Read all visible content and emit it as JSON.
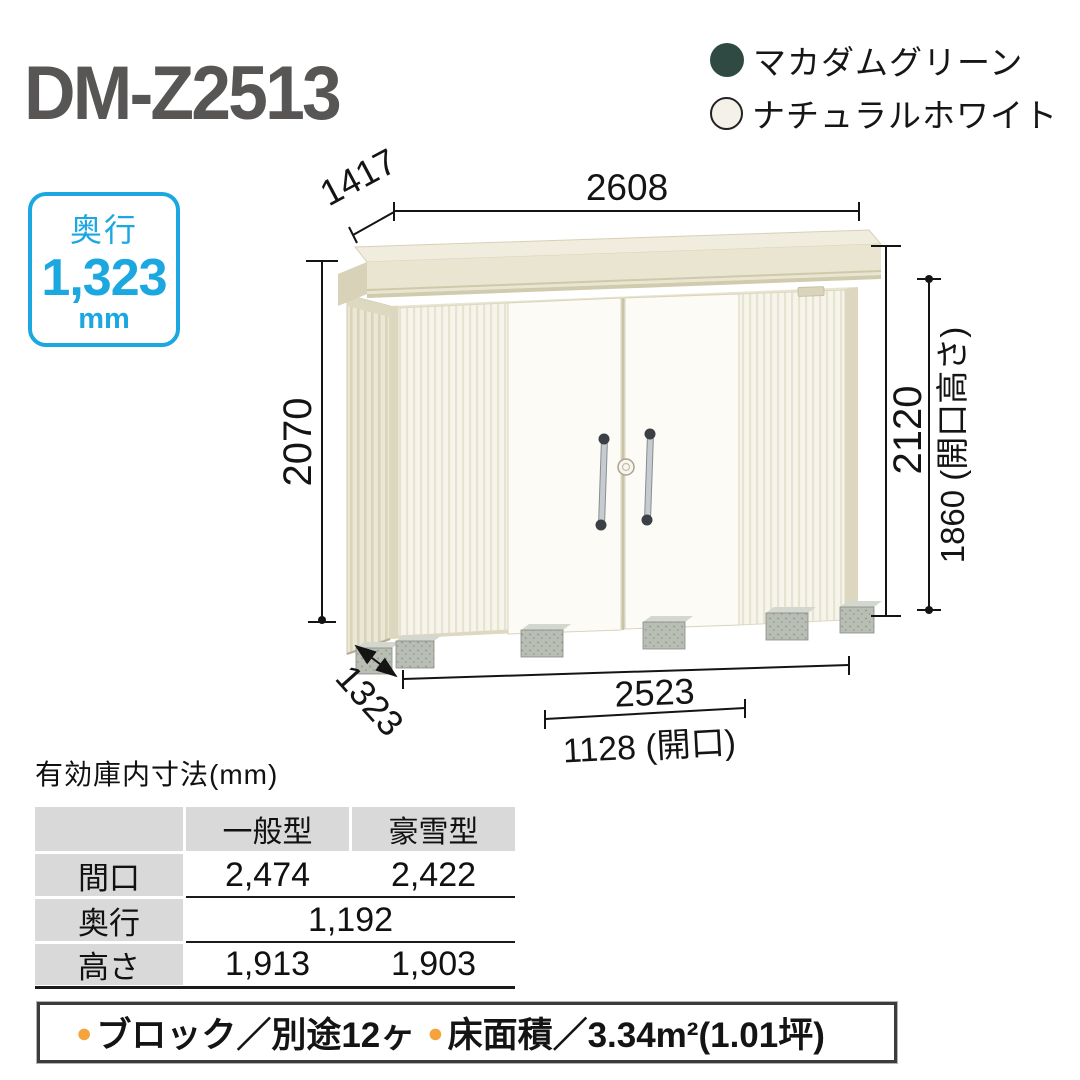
{
  "product": {
    "model": "DM-Z2513"
  },
  "colors_legend": {
    "items": [
      {
        "name": "マカダムグリーン",
        "swatch": "#2e4a42",
        "outlined": false
      },
      {
        "name": "ナチュラルホワイト",
        "swatch": "#f4f1e9",
        "outlined": true
      }
    ]
  },
  "depth_badge": {
    "label": "奥行",
    "value": "1,323",
    "unit": "mm",
    "accent": "#1ba7e0"
  },
  "dimensions": {
    "top_width": "2608",
    "roof_depth": "1417",
    "wall_height": "2070",
    "total_height": "2120",
    "opening_height": "1860 (開口高さ)",
    "base_depth": "1323",
    "base_width": "2523",
    "opening_width": "1128 (開口)"
  },
  "spec_table": {
    "title": "有効庫内寸法(mm)",
    "columns": [
      "一般型",
      "豪雪型"
    ],
    "rows": [
      {
        "label": "間口",
        "general": "2,474",
        "heavy_snow": "2,422"
      },
      {
        "label": "奥行",
        "merged": "1,192"
      },
      {
        "label": "高さ",
        "general": "1,913",
        "heavy_snow": "1,903"
      }
    ]
  },
  "footer_bar": {
    "bullet": "●",
    "bullet_color": "#f5a43c",
    "items": [
      "ブロック／別途12ヶ",
      "床面積／3.34m²(1.01坪)"
    ]
  }
}
